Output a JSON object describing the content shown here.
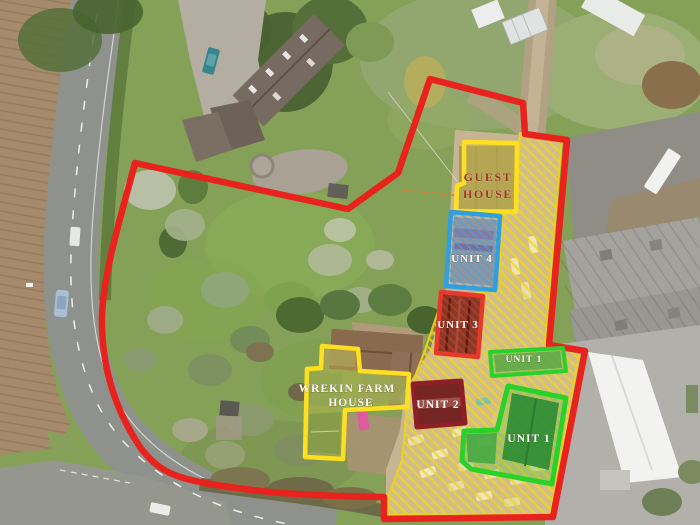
{
  "labels": {
    "guest_house": {
      "line1": "GUEST",
      "line2": "HOUSE"
    },
    "unit_4": "UNIT 4",
    "unit_3": "UNIT 3",
    "unit_2": "UNIT 2",
    "unit_1_upper": "UNIT 1",
    "unit_1_main": "UNIT 1",
    "farmhouse": {
      "line1": "WREKIN FARM",
      "line2": "HOUSE"
    }
  },
  "colors": {
    "boundary_red": "#e8231d",
    "highlight_yellow": "#ffe021",
    "hatch_yellow": "#f3d61e",
    "unit_4_blue": "#2f9fe0",
    "unit_3_red": "#e6392b",
    "unit_2_maroon": "#8e1f26",
    "unit_1_green": "#2bd12b",
    "unit_text": "#ffffff",
    "guest_house_text": "#9c3626"
  }
}
